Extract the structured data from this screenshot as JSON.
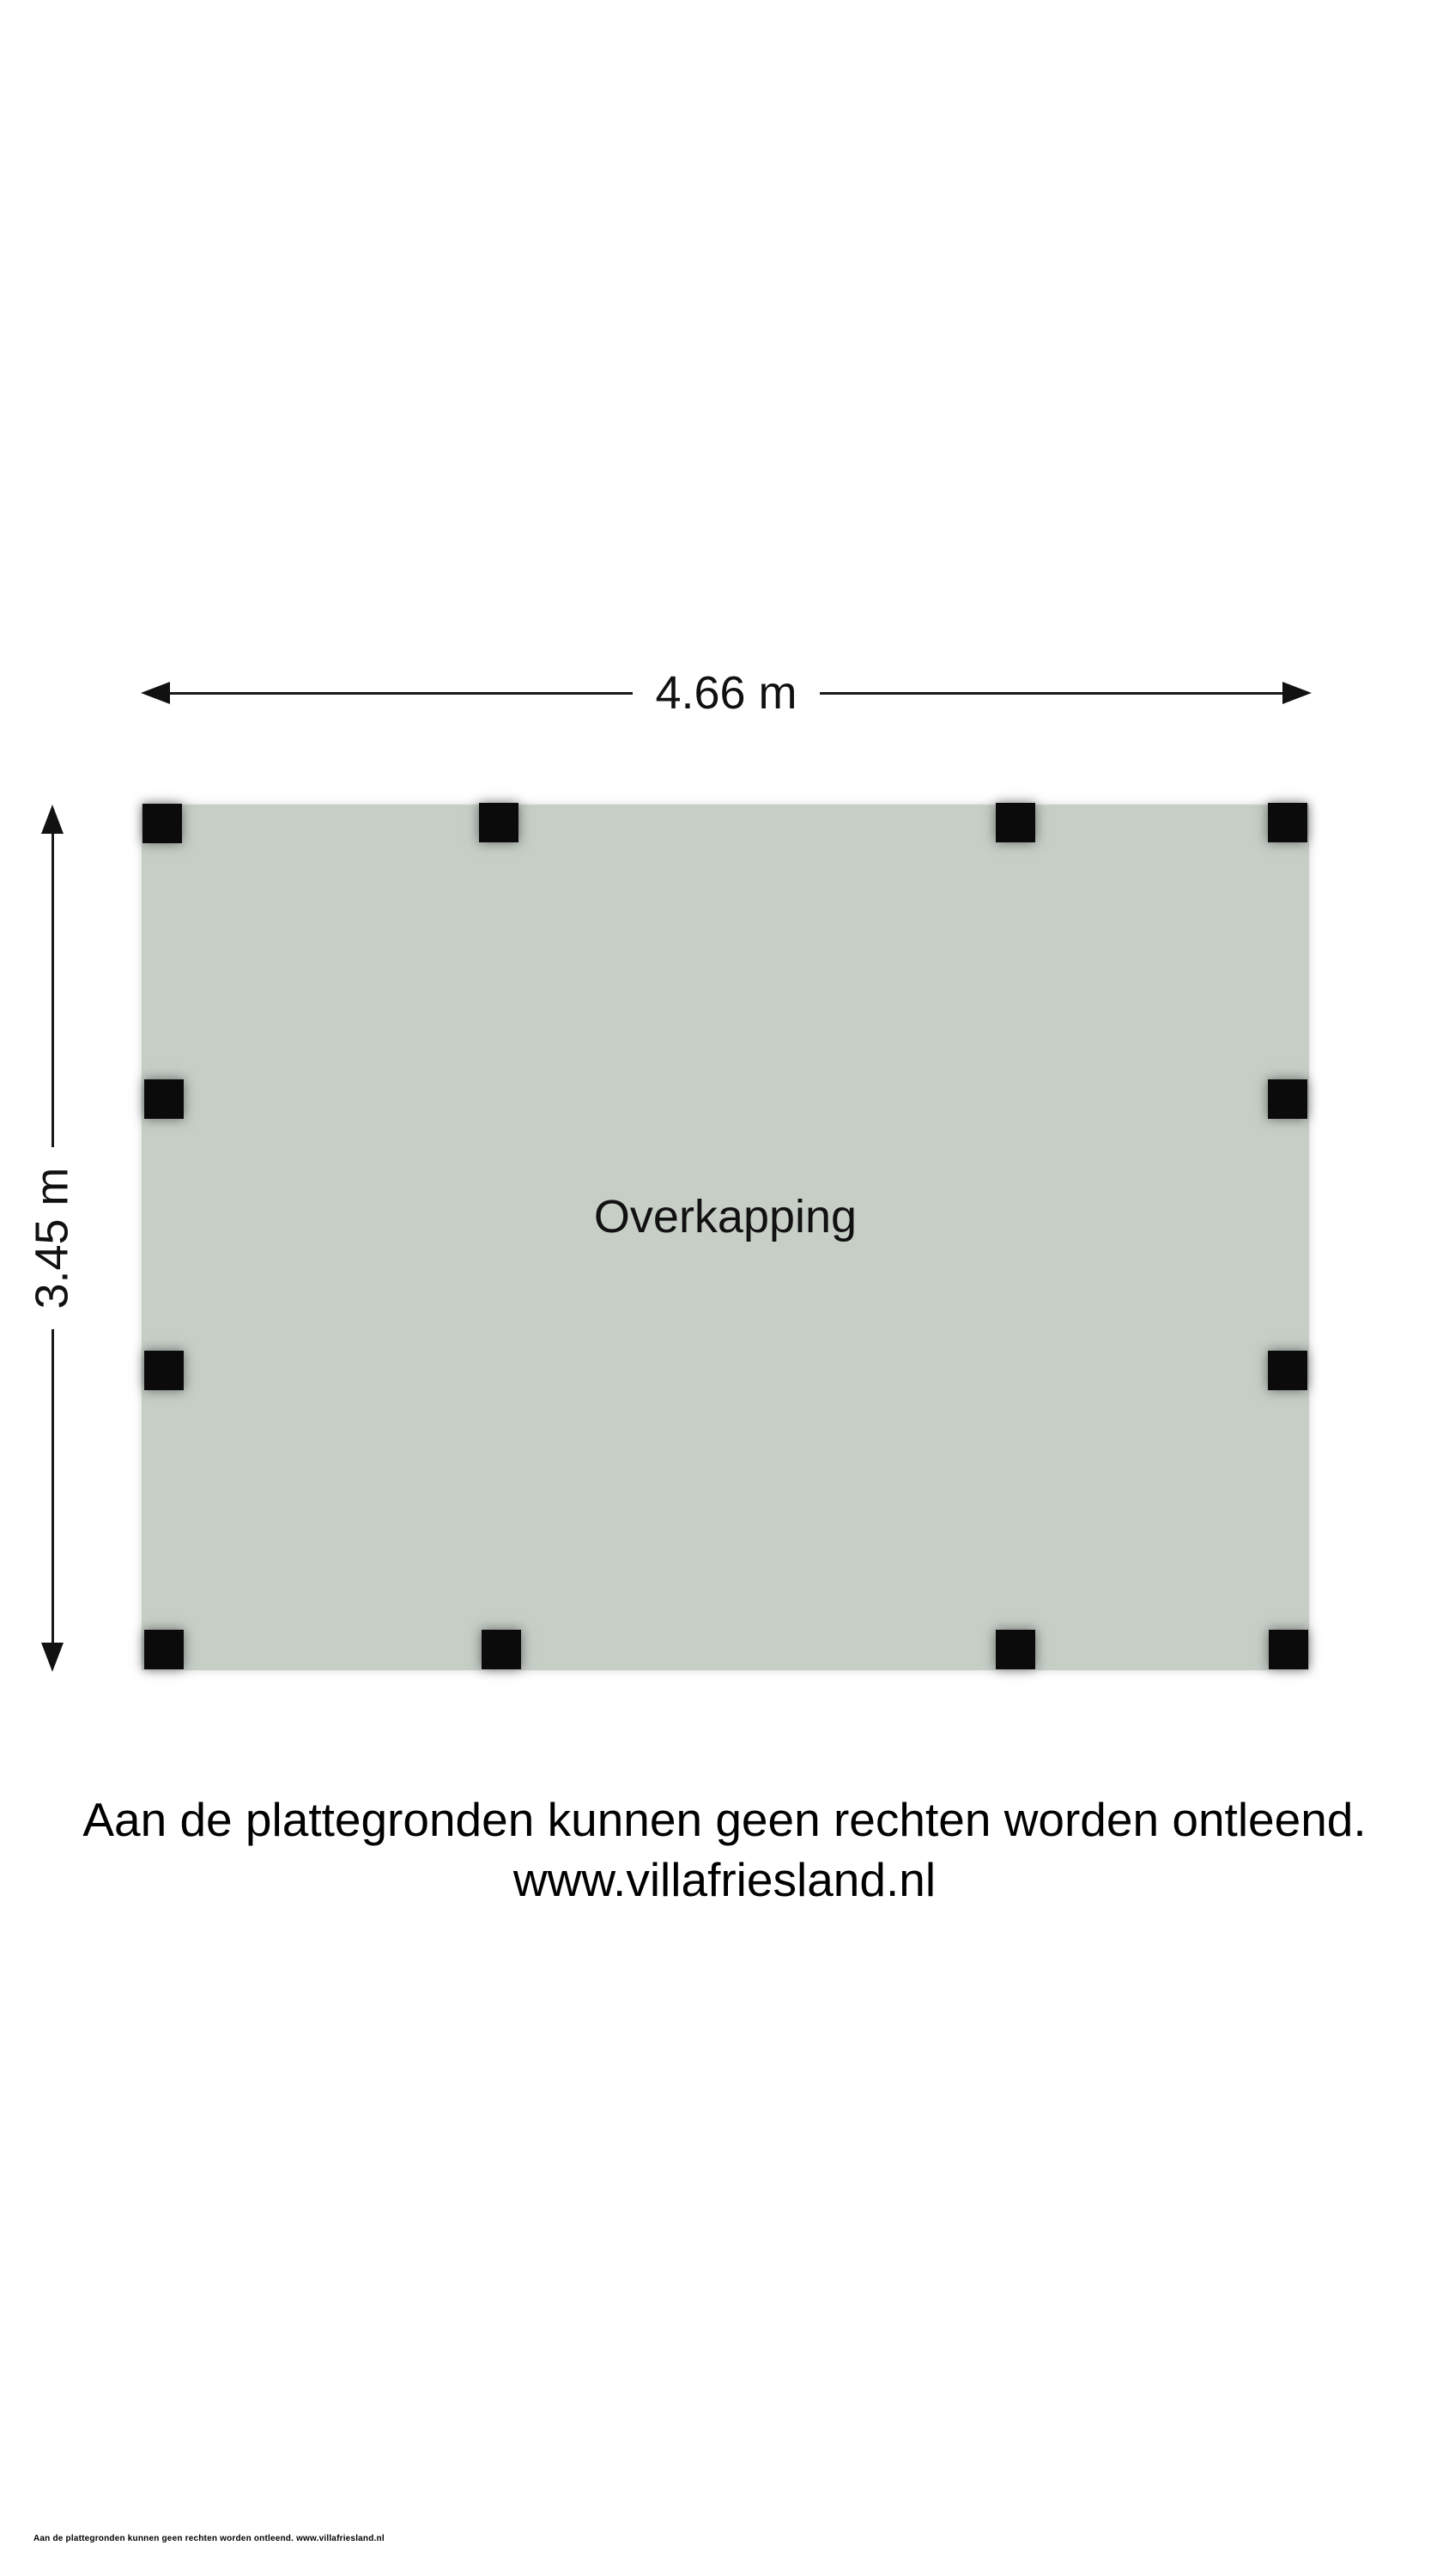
{
  "dimensions": {
    "width_label": "4.66 m",
    "height_label": "3.45 m"
  },
  "room": {
    "label": "Overkapping"
  },
  "disclaimer": {
    "line1": "Aan de plattegronden kunnen geen rechten worden ontleend.",
    "line2": "www.villafriesland.nl"
  },
  "footer": {
    "text": "Aan de plattegronden kunnen geen rechten worden ontleend. www.villafriesland.nl"
  },
  "colors": {
    "floor_fill": "#c6cec6",
    "post": "#0b0b0b",
    "line": "#1a1a1a",
    "background": "#ffffff"
  }
}
